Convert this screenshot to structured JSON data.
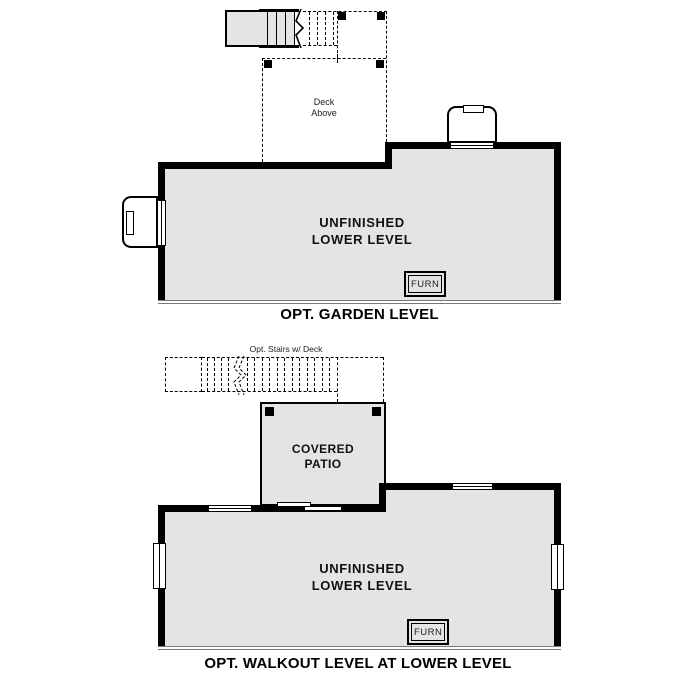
{
  "colors": {
    "floor": "#e4e4e2",
    "wall": "#000000",
    "edge_gray": "#777777"
  },
  "garden_plan": {
    "caption": "OPT. GARDEN LEVEL",
    "deck_label": {
      "line1": "Deck",
      "line2": "Above"
    },
    "room_label": {
      "line1": "UNFINISHED",
      "line2": "LOWER LEVEL"
    },
    "furnace_label": "FURN"
  },
  "walkout_plan": {
    "caption": "OPT. WALKOUT LEVEL AT LOWER LEVEL",
    "stairs_label": "Opt. Stairs w/ Deck",
    "patio_label": {
      "line1": "COVERED",
      "line2": "PATIO"
    },
    "room_label": {
      "line1": "UNFINISHED",
      "line2": "LOWER LEVEL"
    },
    "furnace_label": "FURN"
  }
}
